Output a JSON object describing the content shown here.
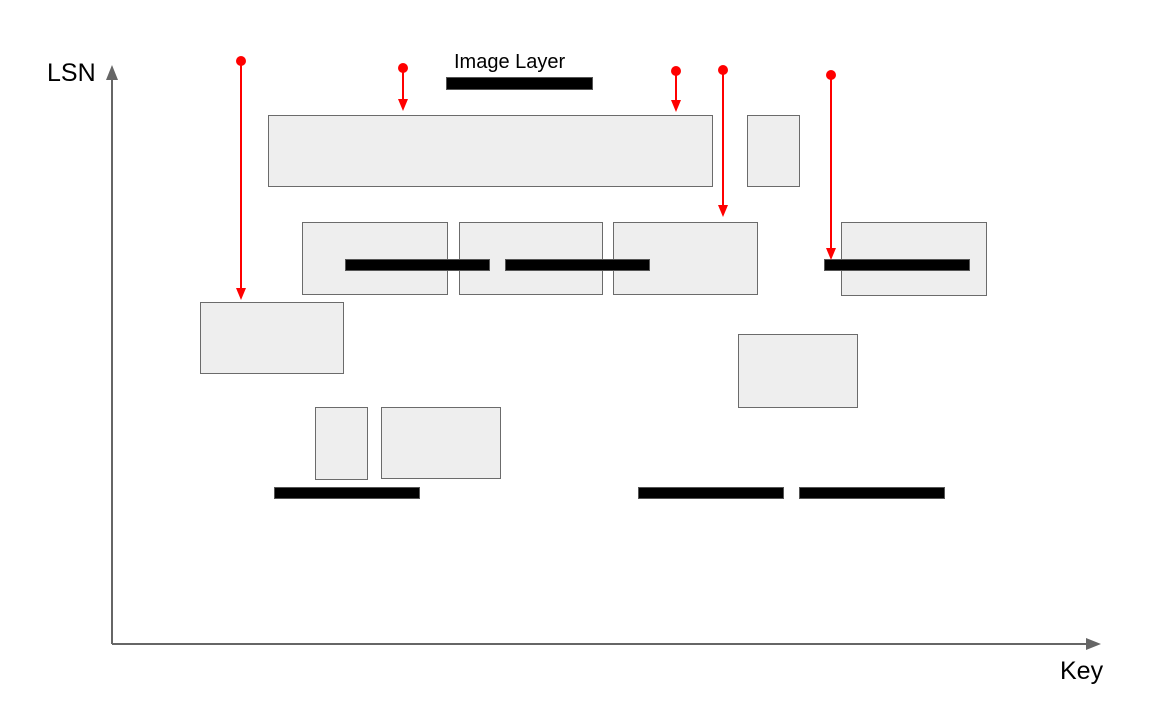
{
  "labels": {
    "y_axis": "LSN",
    "x_axis": "Key",
    "image_layer": "Image Layer",
    "delta_layer": "Delta Layer"
  },
  "colors": {
    "rect_fill": "#eeeeee",
    "rect_stroke": "#6b6b6b",
    "bar_fill": "#000000",
    "arrow": "#ff0000",
    "axis": "#666666",
    "text": "#000000"
  },
  "diagram": {
    "delta_rects": [
      {
        "x": 268,
        "y": 115,
        "w": 445,
        "h": 72
      },
      {
        "x": 747,
        "y": 115,
        "w": 53,
        "h": 72
      },
      {
        "x": 302,
        "y": 222,
        "w": 146,
        "h": 73
      },
      {
        "x": 459,
        "y": 222,
        "w": 144,
        "h": 73
      },
      {
        "x": 613,
        "y": 222,
        "w": 145,
        "h": 73
      },
      {
        "x": 841,
        "y": 222,
        "w": 146,
        "h": 74
      },
      {
        "x": 200,
        "y": 302,
        "w": 144,
        "h": 72
      },
      {
        "x": 738,
        "y": 334,
        "w": 120,
        "h": 74
      },
      {
        "x": 315,
        "y": 407,
        "w": 53,
        "h": 73
      },
      {
        "x": 381,
        "y": 407,
        "w": 120,
        "h": 72
      }
    ],
    "image_bars": [
      {
        "x": 446,
        "y": 77,
        "w": 147,
        "h": 13
      },
      {
        "x": 345,
        "y": 259,
        "w": 145,
        "h": 12
      },
      {
        "x": 505,
        "y": 259,
        "w": 145,
        "h": 12
      },
      {
        "x": 824,
        "y": 259,
        "w": 146,
        "h": 12
      },
      {
        "x": 274,
        "y": 487,
        "w": 146,
        "h": 12
      },
      {
        "x": 638,
        "y": 487,
        "w": 146,
        "h": 12
      },
      {
        "x": 799,
        "y": 487,
        "w": 146,
        "h": 12
      }
    ],
    "arrows": [
      {
        "x": 241,
        "y_start": 61,
        "y_end": 300
      },
      {
        "x": 403,
        "y_start": 68,
        "y_end": 111
      },
      {
        "x": 676,
        "y_start": 71,
        "y_end": 112
      },
      {
        "x": 723,
        "y_start": 70,
        "y_end": 217
      },
      {
        "x": 831,
        "y_start": 75,
        "y_end": 260
      }
    ]
  }
}
